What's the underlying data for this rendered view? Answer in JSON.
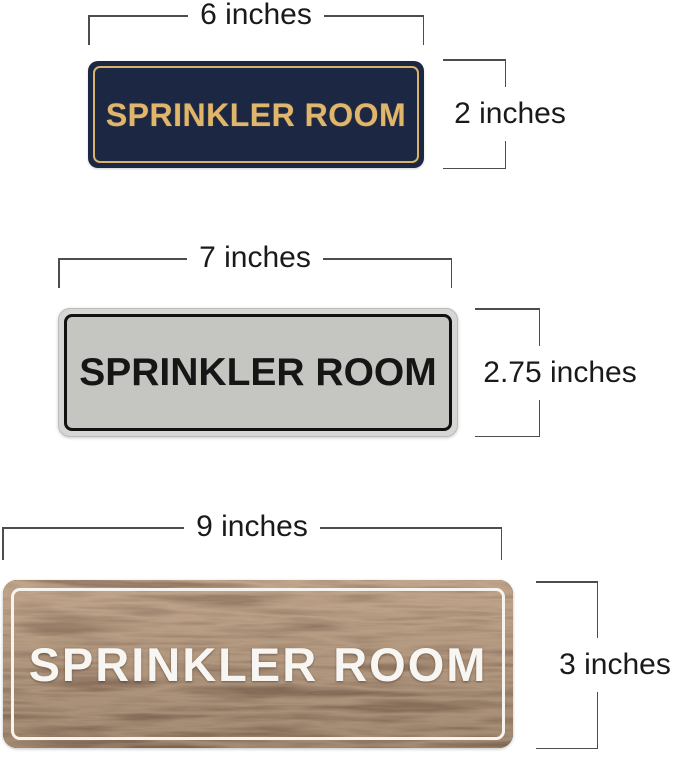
{
  "signs": [
    {
      "name": "navy-gold-sign",
      "label": "SPRINKLER ROOM",
      "width_label": "6 inches",
      "height_label": "2 inches",
      "colors": {
        "background": "#1c2843",
        "border": "#d9b269",
        "text": "#e0b56c"
      }
    },
    {
      "name": "silver-black-sign",
      "label": "SPRINKLER ROOM",
      "width_label": "7 inches",
      "height_label": "2.75 inches",
      "colors": {
        "background": "#c5c6c2",
        "rim": "#d6d6d4",
        "border": "#111111",
        "text": "#161616"
      }
    },
    {
      "name": "walnut-wood-sign",
      "label": "SPRINKLER ROOM",
      "width_label": "9 inches",
      "height_label": "3 inches",
      "colors": {
        "background": "#54392a",
        "wood_dark": "#3a2718",
        "wood_light": "#6f4c2f",
        "border": "#f7f4ef",
        "text": "#f8f6f2"
      }
    }
  ],
  "annotations": {
    "line_color": "#4d4d4d",
    "text_color": "#1a1a1a"
  }
}
